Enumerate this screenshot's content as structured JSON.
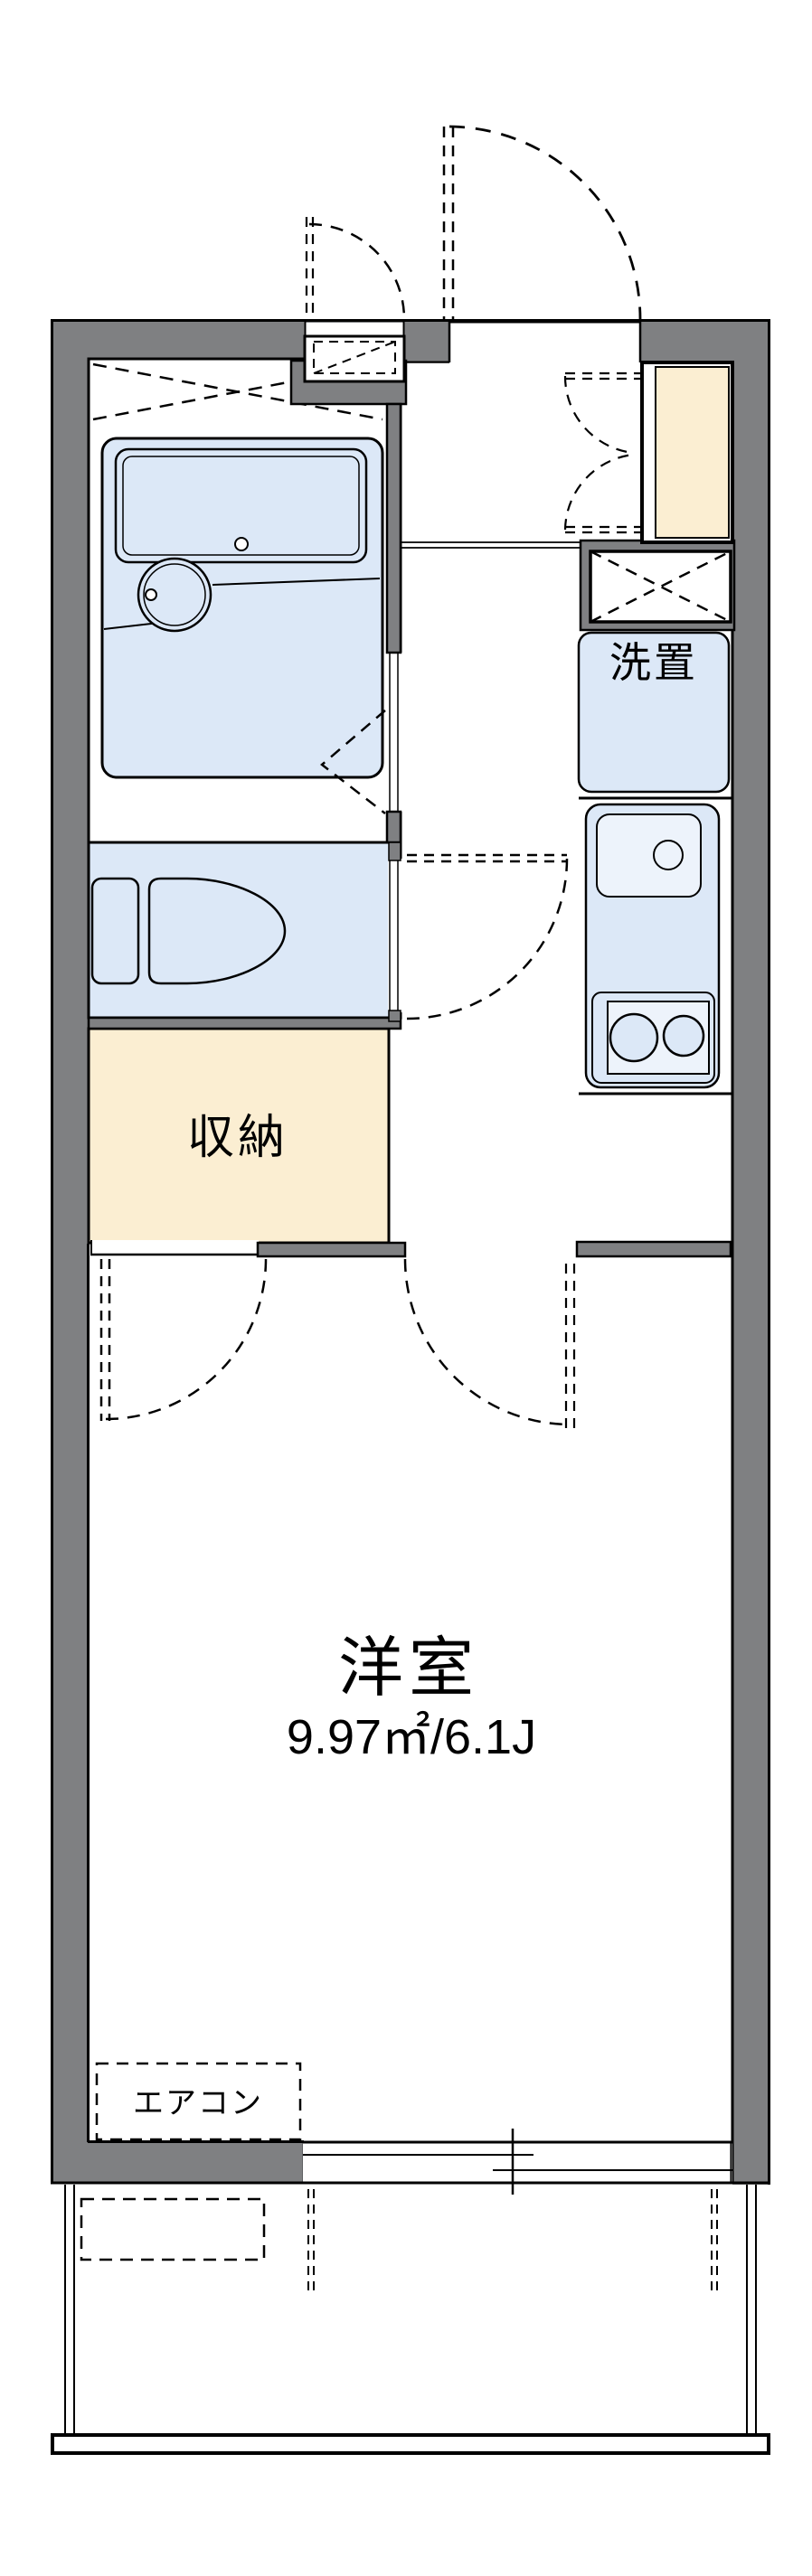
{
  "plan": {
    "main_room": {
      "label": "洋室",
      "area": "9.97㎡/6.1J"
    },
    "storage_label": "収納",
    "washer_label": "洗置",
    "aircon_label": "エアコン",
    "colors": {
      "wall": "#7f8082",
      "fixture_fill": "#dce8f7",
      "fixture_fill_light": "#edf3fb",
      "cabinet_fill": "#fbeed2",
      "outline": "#000000",
      "background": "#ffffff"
    },
    "fixtures": [
      "unit-bath",
      "bathtub",
      "wash-basin",
      "toilet",
      "storage-closet",
      "kitchen-sink",
      "gas-stove",
      "washing-machine-space",
      "shoe-cabinet",
      "meter-box",
      "pipe-space",
      "entrance-door",
      "sliding-window",
      "balcony",
      "air-conditioner"
    ]
  }
}
